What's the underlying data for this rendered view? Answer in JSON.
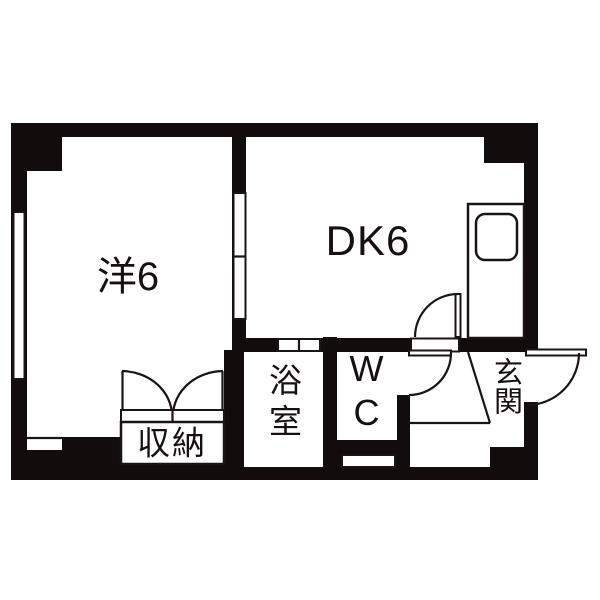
{
  "image_type": "japanese-apartment-floorplan",
  "rooms": {
    "western": {
      "label": "洋6"
    },
    "dining_kitchen": {
      "label": "DK6"
    },
    "bathroom": {
      "label": "浴室"
    },
    "toilet": {
      "label": "WC"
    },
    "entrance": {
      "label": "玄関"
    },
    "storage": {
      "label": "収納"
    }
  },
  "colors": {
    "wall": "#120c0c",
    "line": "#1c1414",
    "floor": "#ffffff",
    "background": "#ffffff"
  }
}
